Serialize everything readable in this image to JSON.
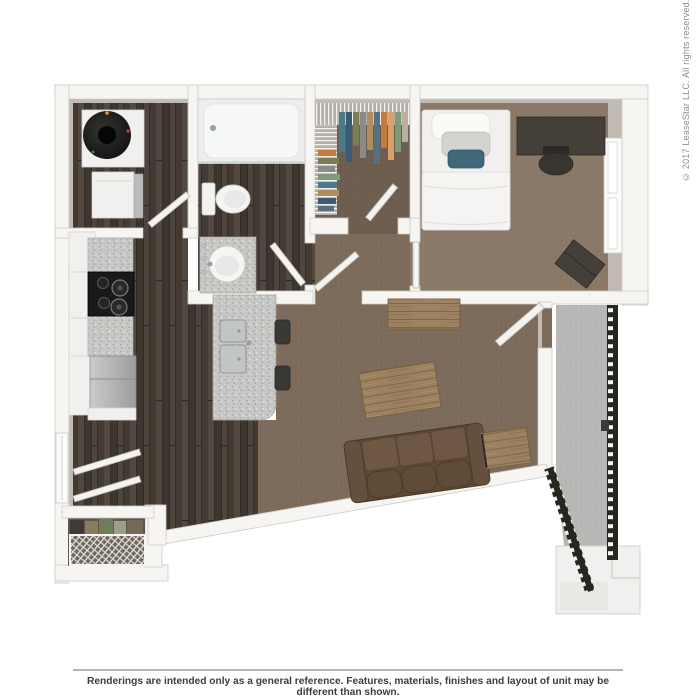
{
  "watermark": {
    "text": "© 2017 LeaseStar LLC. All rights reserved."
  },
  "footer": {
    "disclaimer": "Renderings are intended only as a general reference. Features, materials, finishes and layout of unit may be different than shown."
  },
  "colors": {
    "wall": "#f6f5f2",
    "wallEdge": "#cfccc6",
    "wallFace": "#c1bbb1",
    "carpetLiving": "#7d6b5b",
    "carpetBedroom": "#8b7968",
    "carpetCloset": "#6e5e50",
    "concrete": "#b9b8b6",
    "sofaBody": "#5b4835",
    "sofaSeat": "#6e5844",
    "woodFurniture": "#9c8260",
    "darkFurniture": "#453f3a",
    "whiteFurniture": "#f1f0ee",
    "tealAccent": "#40687a",
    "watermarkText": "#8c8c8c",
    "disclaimerText": "#3d3d3d",
    "dividerLine": "#b5b5b5"
  },
  "floorplan": {
    "type": "3d-rendered-floor-plan",
    "rooms": [
      {
        "name": "laundry-utility",
        "floor": "dark-wood",
        "contents": [
          "water-heater",
          "washer-dryer"
        ]
      },
      {
        "name": "bathroom",
        "floor": "dark-wood",
        "contents": [
          "bathtub",
          "toilet",
          "vanity-sink"
        ]
      },
      {
        "name": "walk-in-closet",
        "floor": "carpet",
        "contents": [
          "wire-shelving",
          "hanging-clothes"
        ]
      },
      {
        "name": "bedroom",
        "floor": "carpet",
        "contents": [
          "bed",
          "desk",
          "desk-chair",
          "dresser",
          "window"
        ]
      },
      {
        "name": "kitchen",
        "floor": "dark-wood",
        "contents": [
          "granite-counter",
          "range",
          "refrigerator",
          "island-double-sink",
          "bar-stools"
        ]
      },
      {
        "name": "living-dining",
        "floor": "carpet",
        "contents": [
          "sofa",
          "coffee-table",
          "console-table",
          "end-table"
        ]
      },
      {
        "name": "entry",
        "floor": "dark-wood",
        "contents": [
          "coat-closet",
          "double-doors",
          "window"
        ]
      },
      {
        "name": "exterior-walkway",
        "floor": "concrete",
        "contents": [
          "railing",
          "landing"
        ]
      }
    ]
  }
}
